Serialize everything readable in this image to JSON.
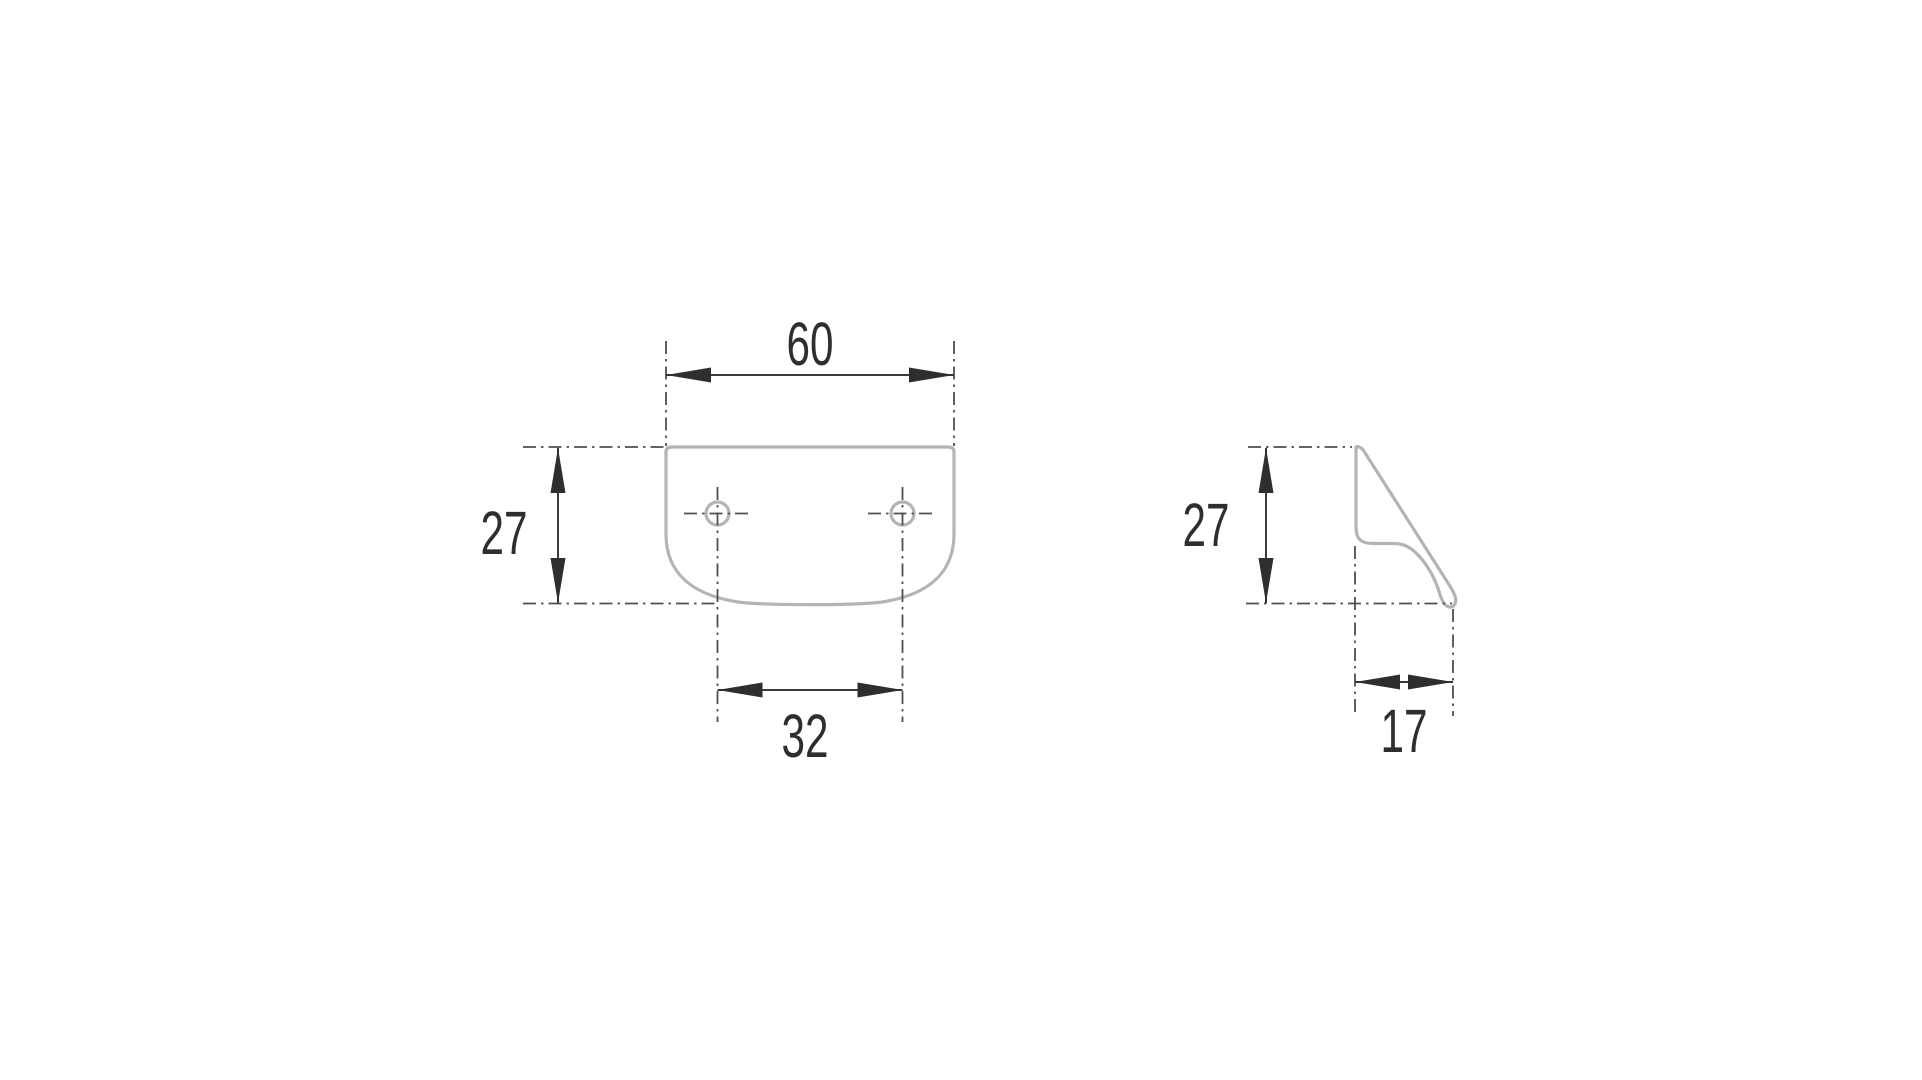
{
  "drawing": {
    "type": "technical-dimension-drawing",
    "subject": "edge pull handle, two orthographic views",
    "background_color": "#ffffff",
    "colors": {
      "part_outline": "#b4b4b4",
      "dimension_lines": "#3a3a3a",
      "dimension_text": "#2e2e2e",
      "centerlines": "#4f4f4f"
    },
    "views": {
      "front": {
        "label": "front view",
        "hole_count": 2,
        "dimensions": {
          "width": "60",
          "height": "27",
          "hole_spacing": "32"
        }
      },
      "side": {
        "label": "side profile view",
        "dimensions": {
          "height": "27",
          "depth": "17"
        }
      }
    }
  }
}
